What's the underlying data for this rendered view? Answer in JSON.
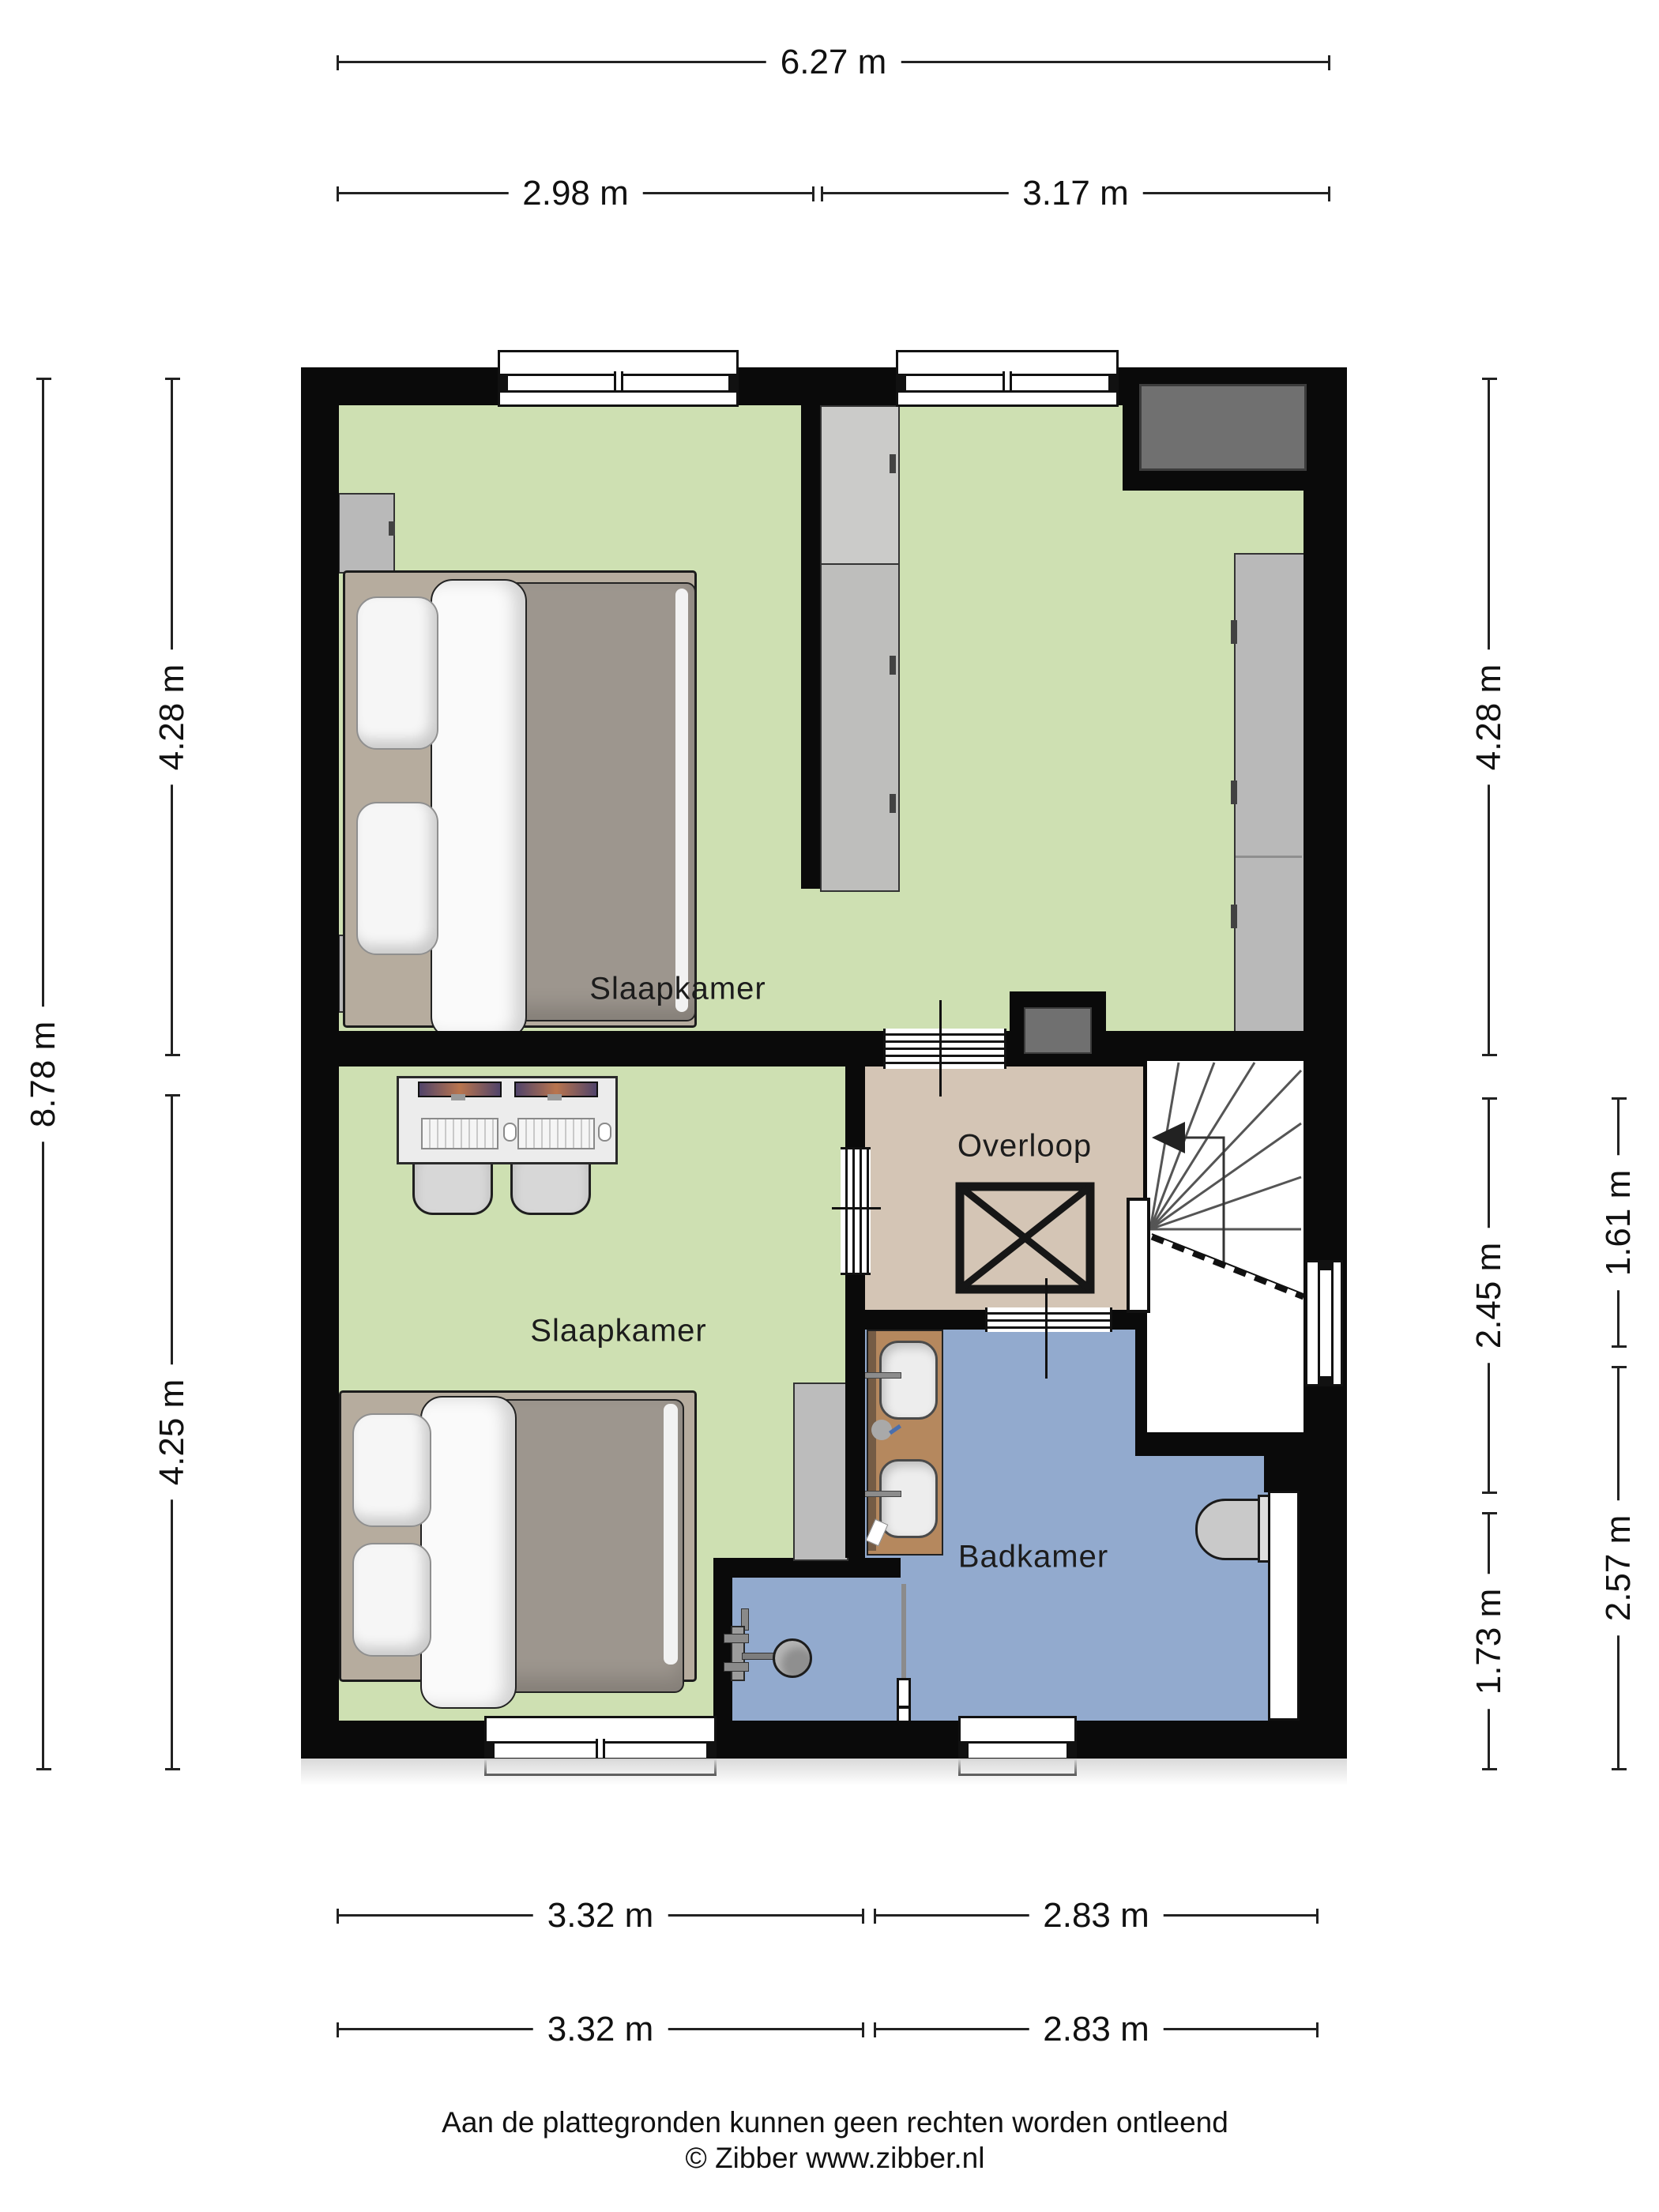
{
  "rooms": {
    "bedroom_top": "Slaapkamer",
    "bedroom_bottom": "Slaapkamer",
    "landing": "Overloop",
    "bathroom": "Badkamer"
  },
  "dimensions": {
    "top_total": "6.27 m",
    "top_seg_left": "2.98 m",
    "top_seg_right": "3.17 m",
    "left_total": "8.78 m",
    "left_seg_upper": "4.28 m",
    "left_seg_lower": "4.25 m",
    "right_inner_upper": "4.28 m",
    "right_inner_mid": "2.45 m",
    "right_inner_lower": "1.73 m",
    "right_outer_upper": "1.61 m",
    "right_outer_lower": "2.57 m",
    "bottom_row1_left": "3.32 m",
    "bottom_row1_right": "2.83 m",
    "bottom_row2_left": "3.32 m",
    "bottom_row2_right": "2.83 m"
  },
  "footer": {
    "disclaimer": "Aan de plattegronden kunnen geen rechten worden ontleend",
    "credit": "© Zibber www.zibber.nl"
  },
  "colors": {
    "wall": "#0a0a0a",
    "floor_bedroom": "#cee0b2",
    "floor_landing": "#d4c5b5",
    "floor_bathroom": "#92aace",
    "wardrobe": "#b9b9b9",
    "vanity_wood": "#b5885e",
    "duct_gray": "#707070"
  }
}
